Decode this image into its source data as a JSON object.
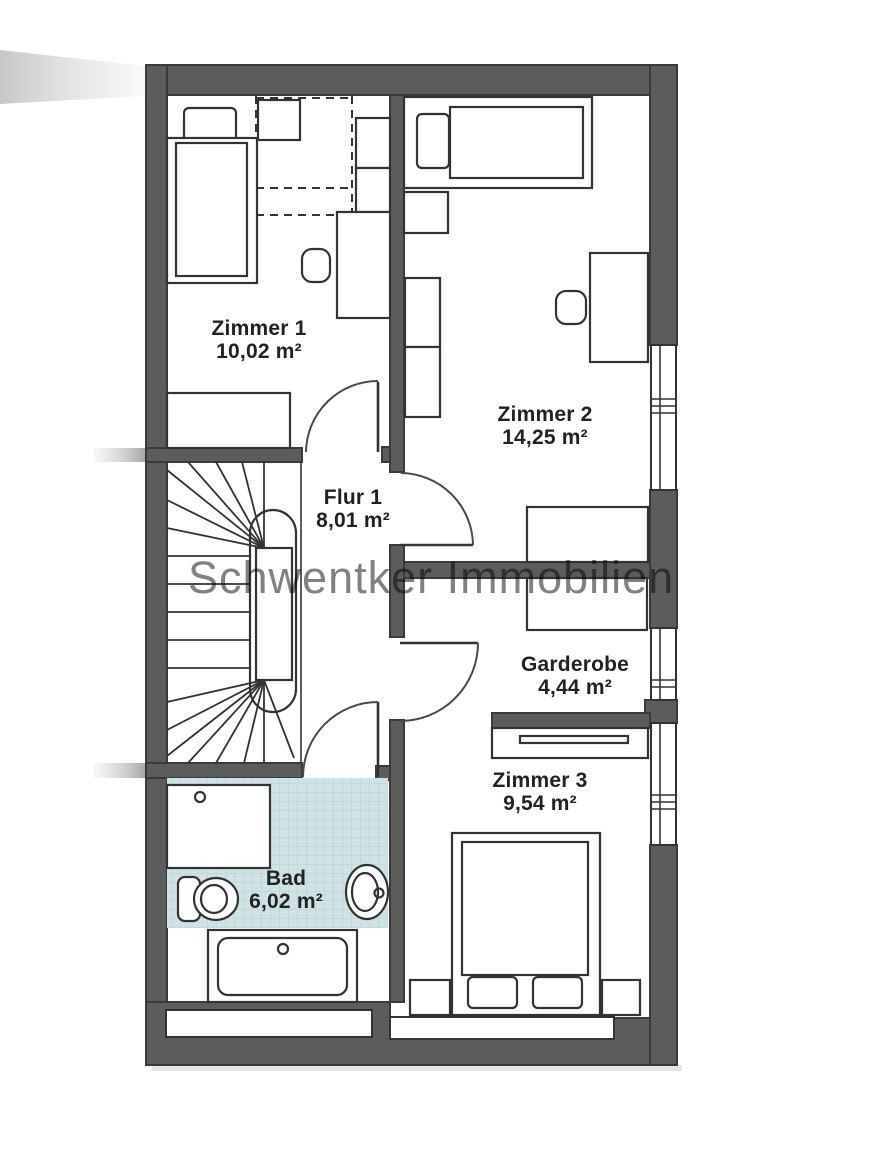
{
  "watermark": "Schwentker Immobilien",
  "rooms": [
    {
      "id": "zimmer1",
      "name": "Zimmer 1",
      "area": "10,02 m²"
    },
    {
      "id": "zimmer2",
      "name": "Zimmer 2",
      "area": "14,25 m²"
    },
    {
      "id": "flur1",
      "name": "Flur 1",
      "area": "8,01 m²"
    },
    {
      "id": "garderobe",
      "name": "Garderobe",
      "area": "4,44 m²"
    },
    {
      "id": "zimmer3",
      "name": "Zimmer 3",
      "area": "9,54 m²"
    },
    {
      "id": "bad",
      "name": "Bad",
      "area": "6,02 m²"
    }
  ],
  "colors": {
    "wall": "#5c5c5c",
    "line": "#333333",
    "tile": "#cfe2e4",
    "tile_grid": "#b7d2d4",
    "watermark": "#6b6b6b",
    "label": "#222222"
  }
}
